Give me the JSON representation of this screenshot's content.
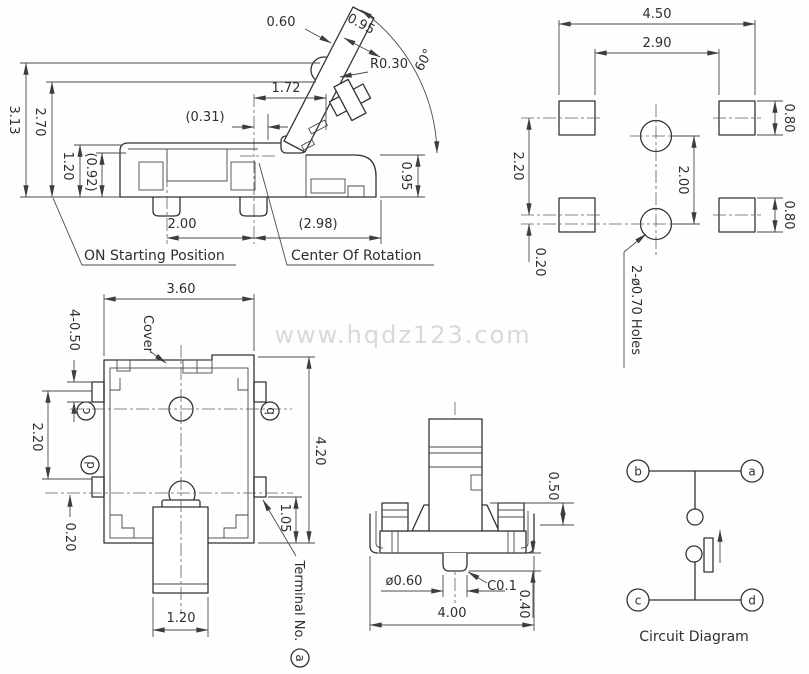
{
  "watermark": "www.hqdz123.com",
  "side_view": {
    "dims": {
      "h_3_13": "3.13",
      "h_2_70": "2.70",
      "h_1_20": "1.20",
      "h_0_92": "(0.92)",
      "lever_0_60": "0.60",
      "lever_0_95": "0.95",
      "r_0_30": "R0.30",
      "angle_60": "60°",
      "d_1_72": "1.72",
      "d_0_31": "(0.31)",
      "d_2_00": "2.00",
      "d_2_98": "(2.98)",
      "h_0_95": "0.95"
    },
    "labels": {
      "on_position": "ON Starting Position",
      "center_of_rotation": "Center Of Rotation"
    }
  },
  "pcb_view": {
    "dims": {
      "w_4_50": "4.50",
      "w_2_90": "2.90",
      "pad_h_top": "0.80",
      "pad_h_bottom": "0.80",
      "s_2_20": "2.20",
      "s_0_20": "0.20",
      "hole_pitch_2_00": "2.00"
    },
    "labels": {
      "holes": "2-ø0.70 Holes"
    }
  },
  "top_view": {
    "dims": {
      "w_3_60": "3.60",
      "t_4_0_50": "4-0.50",
      "s_2_20": "2.20",
      "s_0_20": "0.20",
      "h_4_20": "4.20",
      "h_1_05": "1.05",
      "w_1_20": "1.20"
    },
    "labels": {
      "cover": "Cover",
      "terminal_no": "Terminal No.",
      "terminal_letter": "a",
      "term_c": "c",
      "term_d": "d",
      "term_b": "b"
    }
  },
  "front_view": {
    "dims": {
      "h_0_50": "0.50",
      "dia_0_60": "ø0.60",
      "c_0_1": "C0.1",
      "w_4_00": "4.00",
      "h_0_40": "0.40"
    }
  },
  "circuit": {
    "caption": "Circuit Diagram",
    "terminals": {
      "a": "a",
      "b": "b",
      "c": "c",
      "d": "d"
    }
  }
}
